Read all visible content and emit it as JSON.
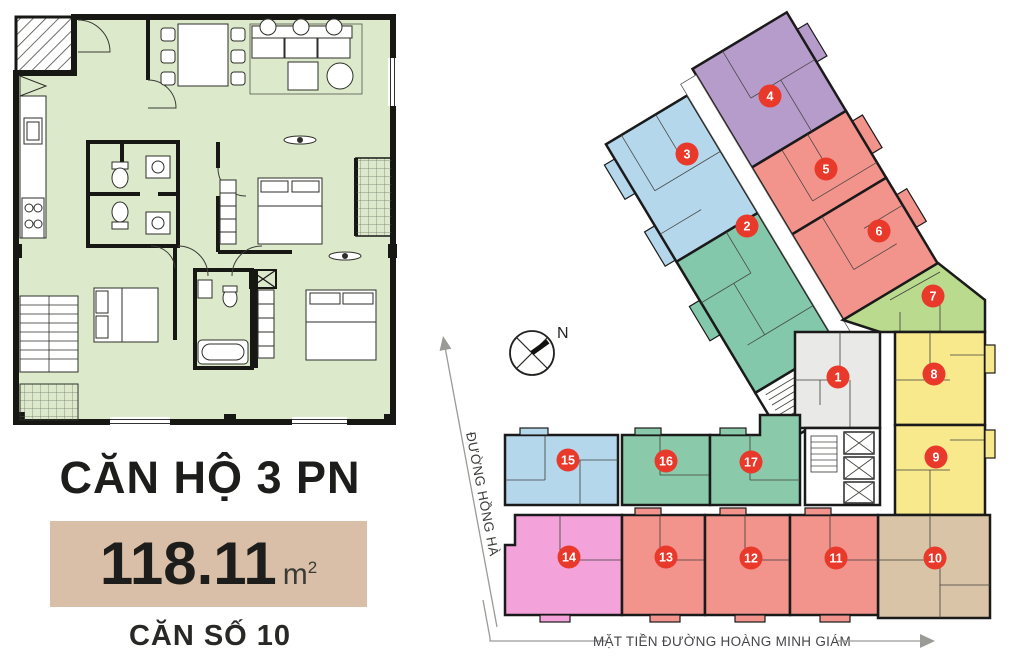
{
  "left_panel": {
    "unit_type_label": "CĂN HỘ 3 PN",
    "area_value": "118.11",
    "area_unit_base": "m",
    "area_unit_exponent": "2",
    "unit_number_label": "CĂN SỐ 10",
    "area_box_color": "#d9bfa7",
    "plan_room_color": "#dde9cb",
    "wall_color": "#171714"
  },
  "site_plan": {
    "compass_label": "N",
    "streets": [
      {
        "name": "ĐƯỜNG HỒNG HÀ"
      },
      {
        "name": "MẶT TIỀN ĐƯỜNG HOÀNG MINH GIÁM"
      }
    ],
    "badge_color": "#e8392b",
    "badge_text_color": "#ffffff",
    "units": [
      {
        "number": "1",
        "color": "#e9e9e7"
      },
      {
        "number": "2",
        "color": "#84c8ab"
      },
      {
        "number": "3",
        "color": "#b5d7ec"
      },
      {
        "number": "4",
        "color": "#b69cca"
      },
      {
        "number": "5",
        "color": "#f2938c"
      },
      {
        "number": "6",
        "color": "#f2938c"
      },
      {
        "number": "7",
        "color": "#bada8e"
      },
      {
        "number": "8",
        "color": "#f7e98c"
      },
      {
        "number": "9",
        "color": "#f7e98c"
      },
      {
        "number": "10",
        "color": "#d9c4a7"
      },
      {
        "number": "11",
        "color": "#f2938c"
      },
      {
        "number": "12",
        "color": "#f2938c"
      },
      {
        "number": "13",
        "color": "#f2938c"
      },
      {
        "number": "14",
        "color": "#f4a3da"
      },
      {
        "number": "15",
        "color": "#b5d7ec"
      },
      {
        "number": "16",
        "color": "#8acaab"
      },
      {
        "number": "17",
        "color": "#8acaab"
      }
    ]
  }
}
